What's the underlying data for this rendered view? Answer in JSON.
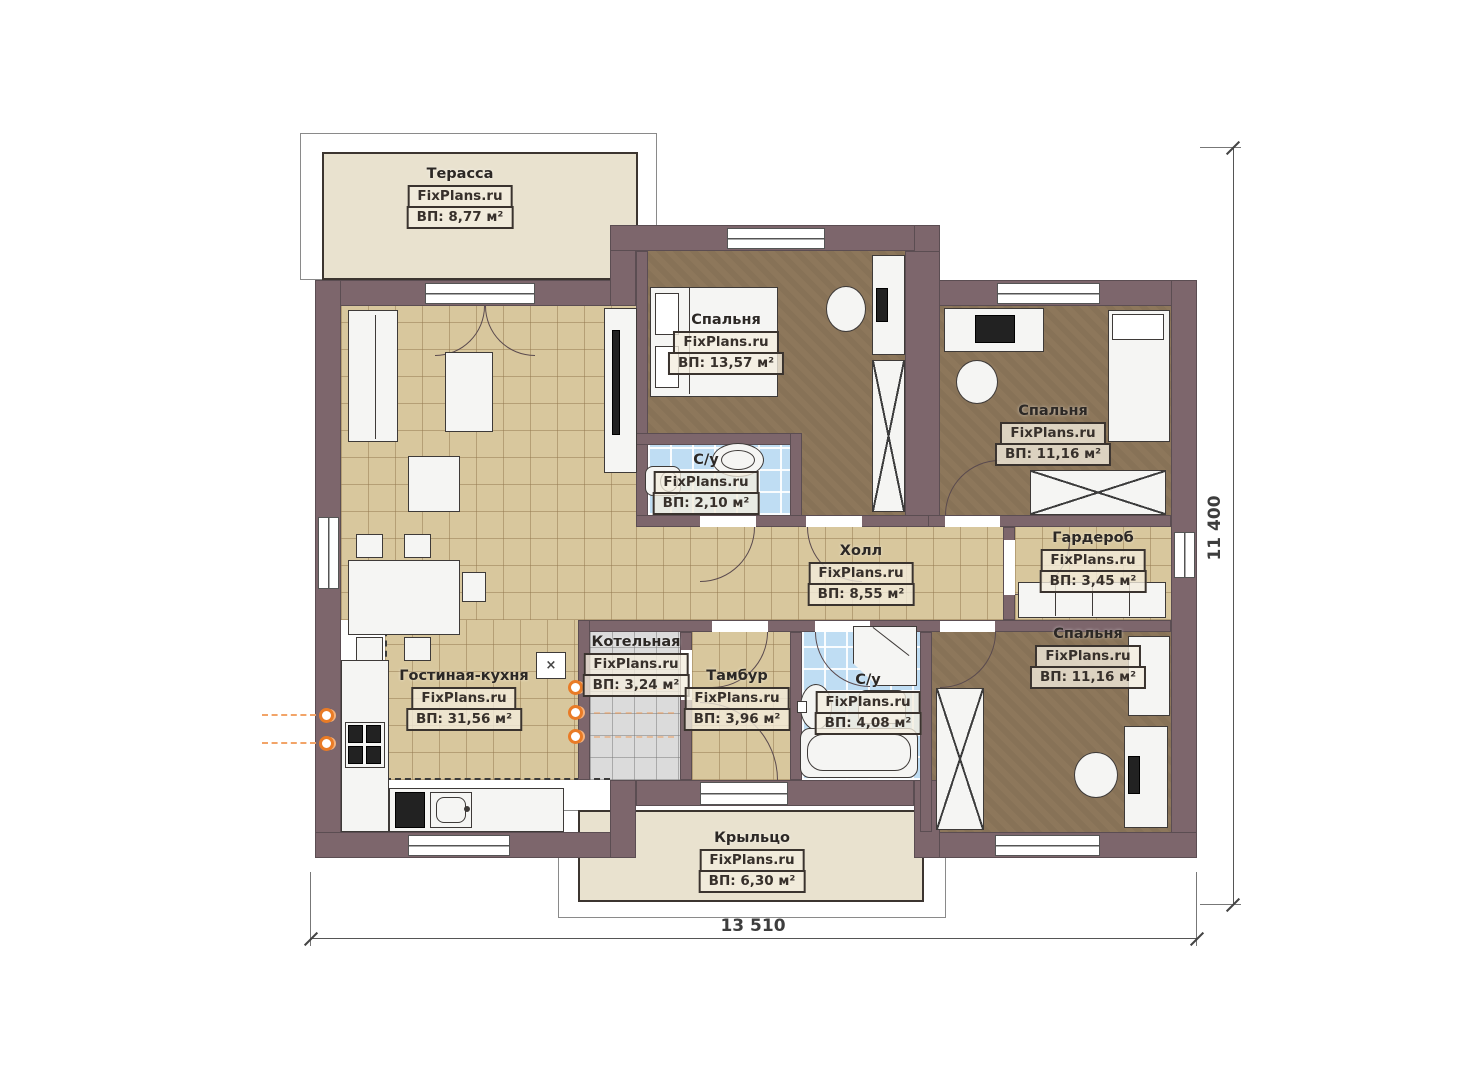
{
  "rooms": [
    {
      "id": "terrace",
      "name": "Терасса",
      "watermark": "FixPlans.ru",
      "area": "ВП: 8,77 м²"
    },
    {
      "id": "bedroom-top",
      "name": "Спальня",
      "watermark": "FixPlans.ru",
      "area": "ВП: 13,57 м²"
    },
    {
      "id": "bathroom-small",
      "name": "С/у",
      "watermark": "FixPlans.ru",
      "area": "ВП: 2,10 м²"
    },
    {
      "id": "bedroom-top-right",
      "name": "Спальня",
      "watermark": "FixPlans.ru",
      "area": "ВП: 11,16 м²"
    },
    {
      "id": "wardrobe-room",
      "name": "Гардероб",
      "watermark": "FixPlans.ru",
      "area": "ВП: 3,45 м²"
    },
    {
      "id": "hall",
      "name": "Холл",
      "watermark": "FixPlans.ru",
      "area": "ВП: 8,55 м²"
    },
    {
      "id": "boiler-room",
      "name": "Котельная",
      "watermark": "FixPlans.ru",
      "area": "ВП: 3,24 м²"
    },
    {
      "id": "vestibule",
      "name": "Тамбур",
      "watermark": "FixPlans.ru",
      "area": "ВП: 3,96 м²"
    },
    {
      "id": "bathroom-big",
      "name": "С/у",
      "watermark": "FixPlans.ru",
      "area": "ВП: 4,08 м²"
    },
    {
      "id": "bedroom-bottom-right",
      "name": "Спальня",
      "watermark": "FixPlans.ru",
      "area": "ВП: 11,16 м²"
    },
    {
      "id": "living-kitchen",
      "name": "Гостиная-кухня",
      "watermark": "FixPlans.ru",
      "area": "ВП: 31,56 м²"
    },
    {
      "id": "porch",
      "name": "Крыльцо",
      "watermark": "FixPlans.ru",
      "area": "ВП: 6,30 м²"
    }
  ],
  "dimensions": {
    "width": "13 510",
    "height": "11 400"
  },
  "misc": {
    "cross_symbol": "×"
  },
  "colors": {
    "wall": "#7d666c",
    "tan_floor": "#d8c79d",
    "bedroom_floor": "#8d775b",
    "bath_floor": "#bfddf3",
    "boiler_floor": "#dbdbdb",
    "outdoor_floor": "#e9e2cf",
    "radiator": "#e97b26"
  }
}
